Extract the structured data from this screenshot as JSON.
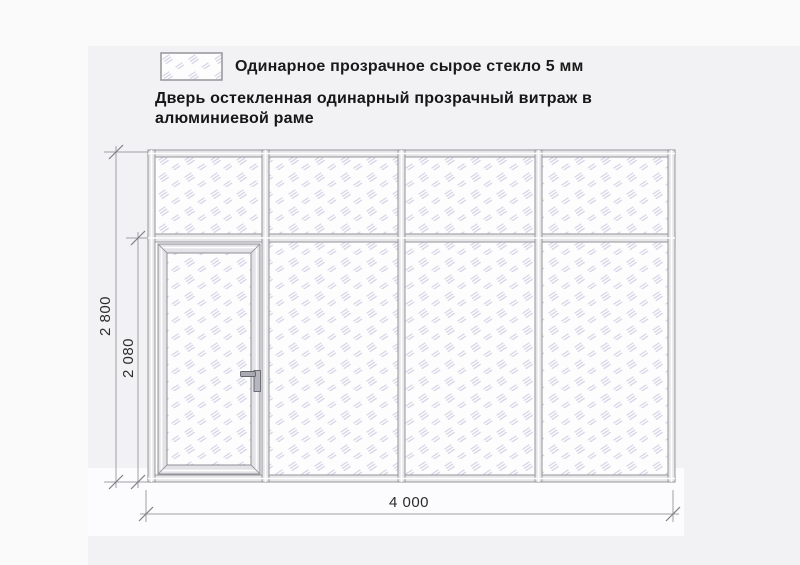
{
  "legend": {
    "label": "Одинарное прозрачное сырое стекло 5 мм"
  },
  "title": {
    "line1": "Дверь остекленная одинарный прозрачный витраж в",
    "line2": "алюминиевой раме"
  },
  "drawing": {
    "dimensions": {
      "overall_height_mm": "2 800",
      "door_height_mm": "2 080",
      "overall_width_mm": "4 000"
    },
    "structure": {
      "bays": 4,
      "top_row_panels": 4,
      "door_position": "first bay, below transom",
      "door_handle_side": "right"
    },
    "colors": {
      "frame_fill": "#e6e6e9",
      "frame_stroke": "#8f8f94",
      "glass_hatch": "#d6d6e7",
      "glass_fill": "#fdfdfe",
      "dimension_line": "#a0a0a3",
      "text": "#1a1a1a"
    }
  }
}
